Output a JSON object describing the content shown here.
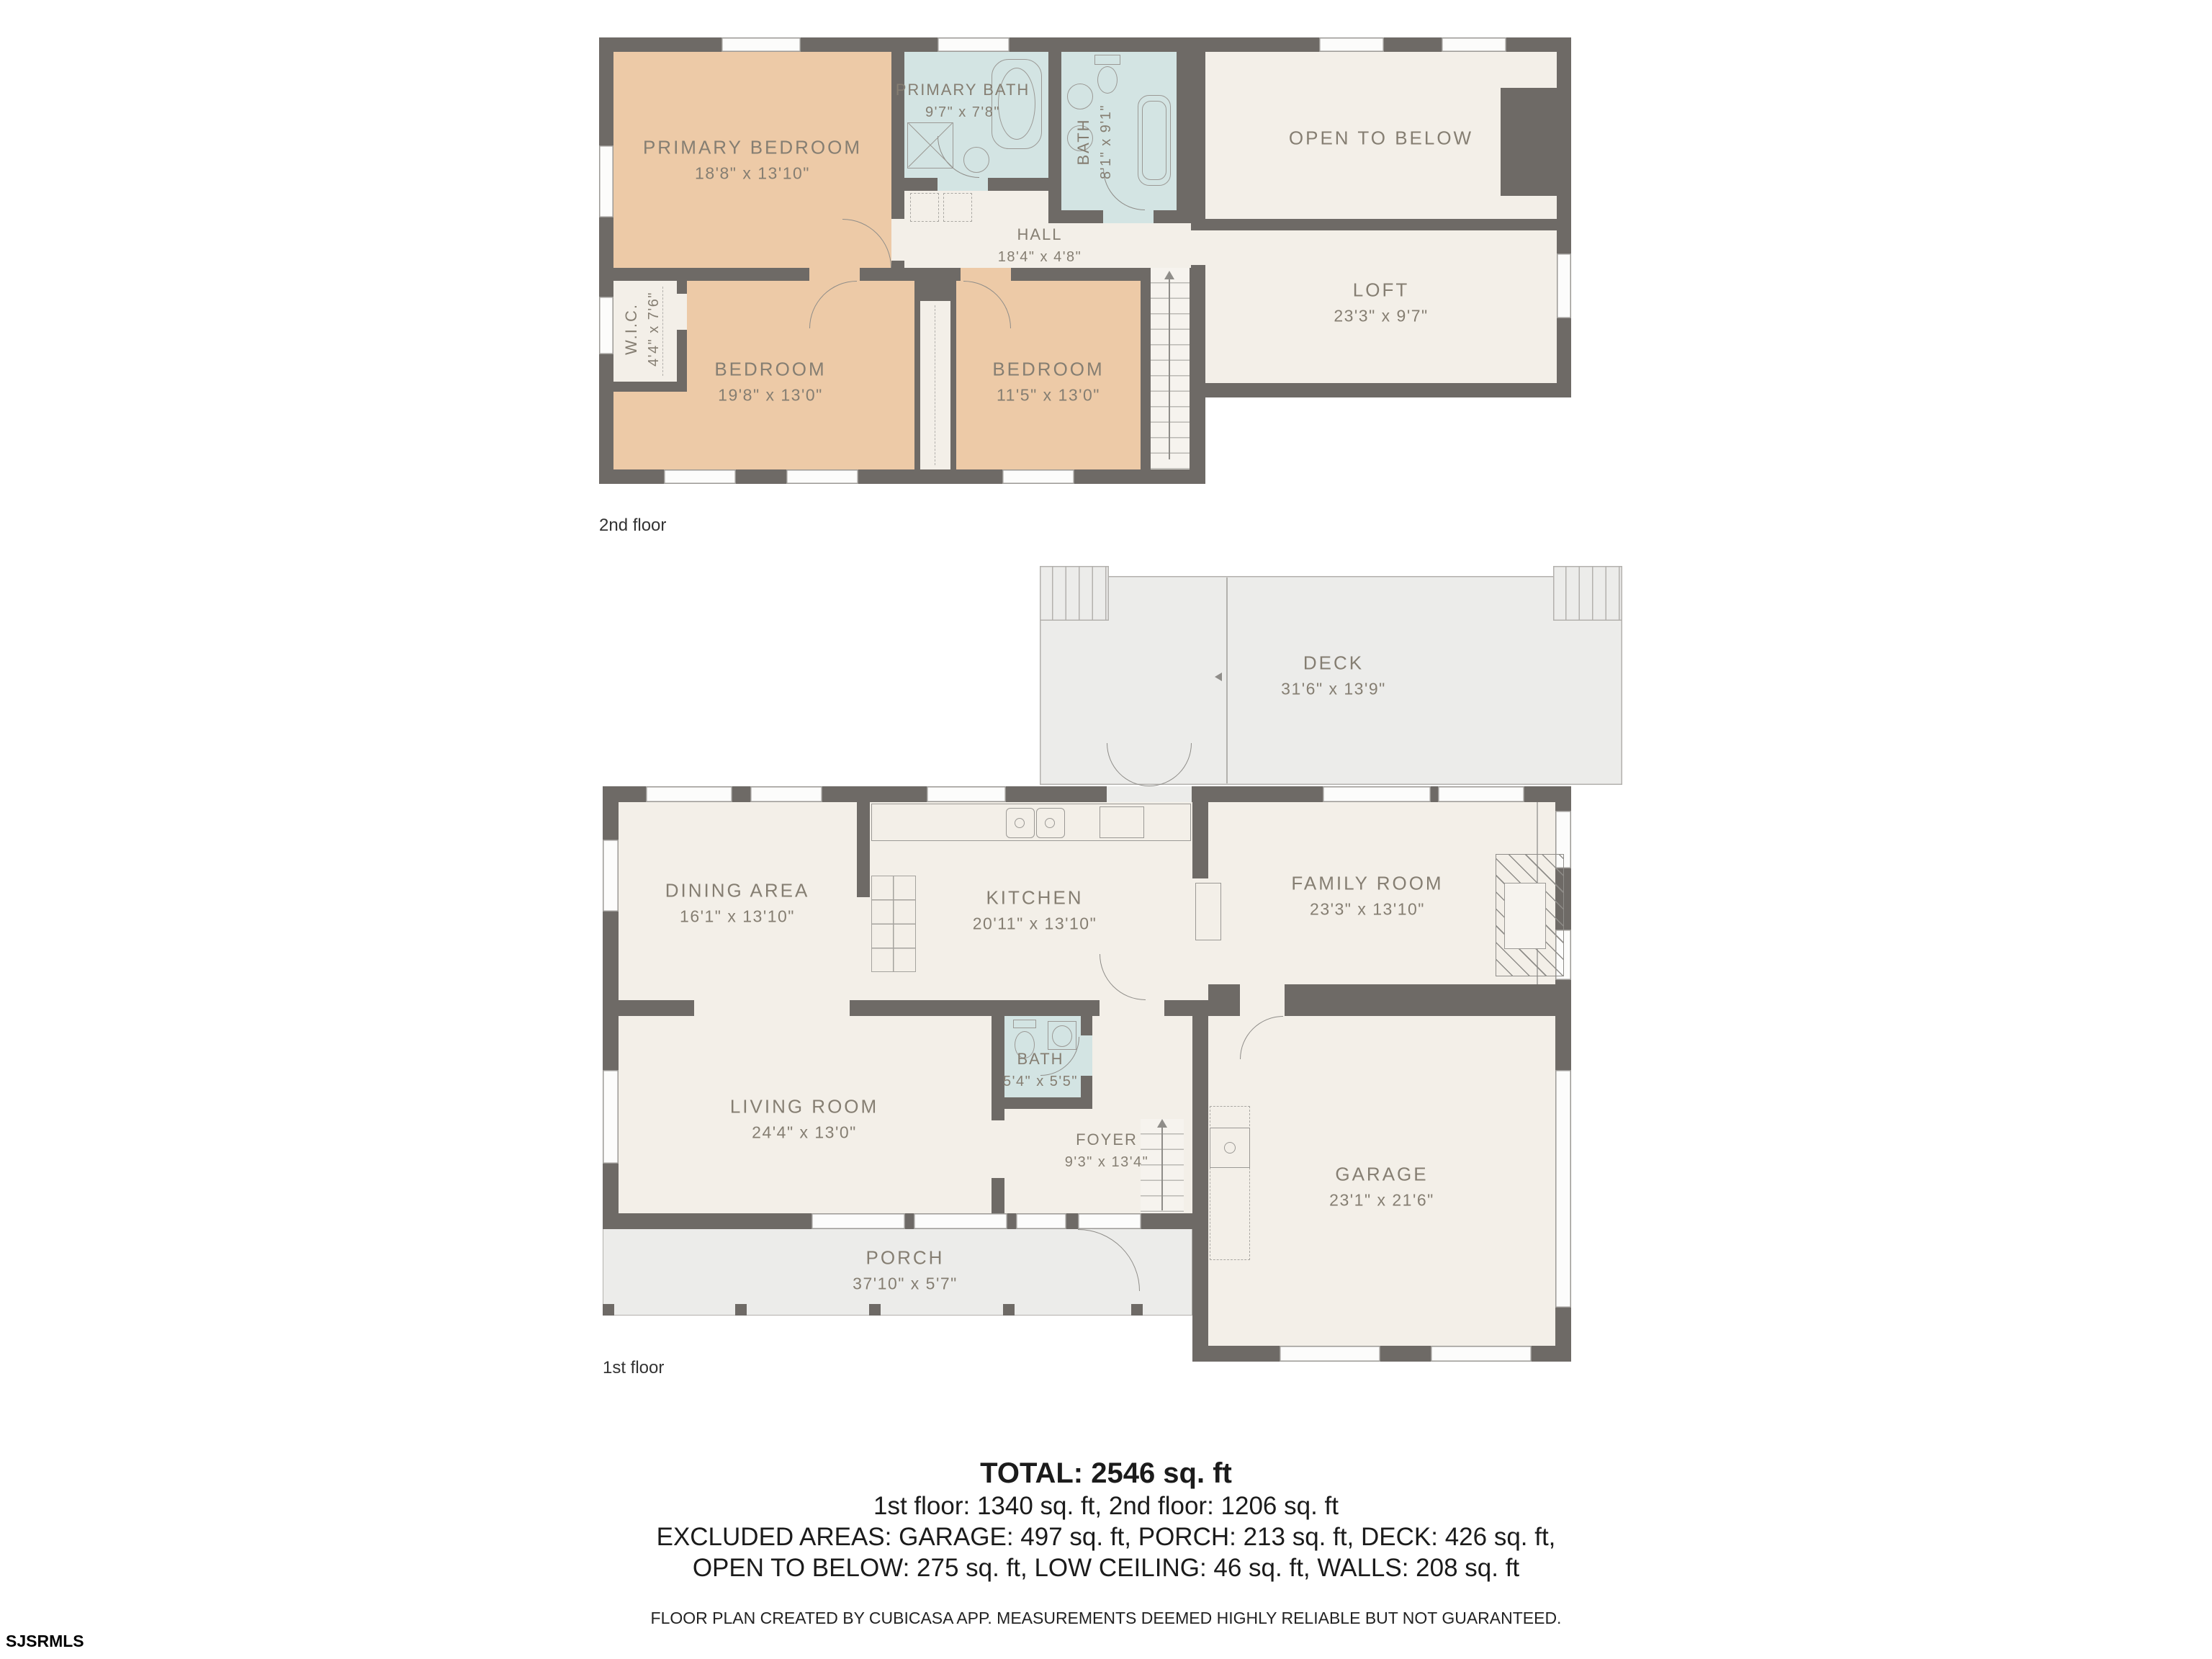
{
  "colors": {
    "wall": "#6e6a66",
    "bedroom_fill": "#edcaa7",
    "bathroom_fill": "#d3e4e3",
    "interior_fill": "#f3efe8",
    "outdoor_fill": "#ececea",
    "label_text": "#857e72",
    "summary_text": "#1b1b1b"
  },
  "floors": {
    "second": {
      "label": "2nd floor",
      "rooms": [
        {
          "name": "PRIMARY BEDROOM",
          "dims": "18'8\" x 13'10\""
        },
        {
          "name": "PRIMARY BATH",
          "dims": "9'7\" x 7'8\""
        },
        {
          "name": "BATH",
          "dims": "8'1\" x 9'1\""
        },
        {
          "name": "OPEN TO BELOW",
          "dims": ""
        },
        {
          "name": "HALL",
          "dims": "18'4\" x 4'8\""
        },
        {
          "name": "LOFT",
          "dims": "23'3\" x 9'7\""
        },
        {
          "name": "W.I.C.",
          "dims": "4'4\" x 7'6\""
        },
        {
          "name": "BEDROOM",
          "dims": "19'8\" x 13'0\""
        },
        {
          "name": "BEDROOM",
          "dims": "11'5\" x 13'0\""
        }
      ]
    },
    "first": {
      "label": "1st floor",
      "rooms": [
        {
          "name": "DECK",
          "dims": "31'6\" x 13'9\""
        },
        {
          "name": "DINING AREA",
          "dims": "16'1\" x 13'10\""
        },
        {
          "name": "KITCHEN",
          "dims": "20'11\" x 13'10\""
        },
        {
          "name": "FAMILY ROOM",
          "dims": "23'3\" x 13'10\""
        },
        {
          "name": "LIVING ROOM",
          "dims": "24'4\" x 13'0\""
        },
        {
          "name": "BATH",
          "dims": "5'4\" x 5'5\""
        },
        {
          "name": "FOYER",
          "dims": "9'3\" x 13'4\""
        },
        {
          "name": "GARAGE",
          "dims": "23'1\" x 21'6\""
        },
        {
          "name": "PORCH",
          "dims": "37'10\" x 5'7\""
        }
      ]
    }
  },
  "summary": {
    "total": "TOTAL: 2546 sq. ft",
    "line1": "1st floor: 1340 sq. ft, 2nd floor: 1206 sq. ft",
    "line2": "EXCLUDED AREAS: GARAGE: 497 sq. ft, PORCH: 213 sq. ft, DECK: 426 sq. ft,",
    "line3": "OPEN TO BELOW: 275 sq. ft, LOW CEILING: 46 sq. ft, WALLS: 208 sq. ft",
    "disclaimer": "FLOOR PLAN CREATED BY CUBICASA APP. MEASUREMENTS DEEMED HIGHLY RELIABLE BUT NOT GUARANTEED."
  },
  "branding": {
    "watermark": "SJSRMLS"
  }
}
